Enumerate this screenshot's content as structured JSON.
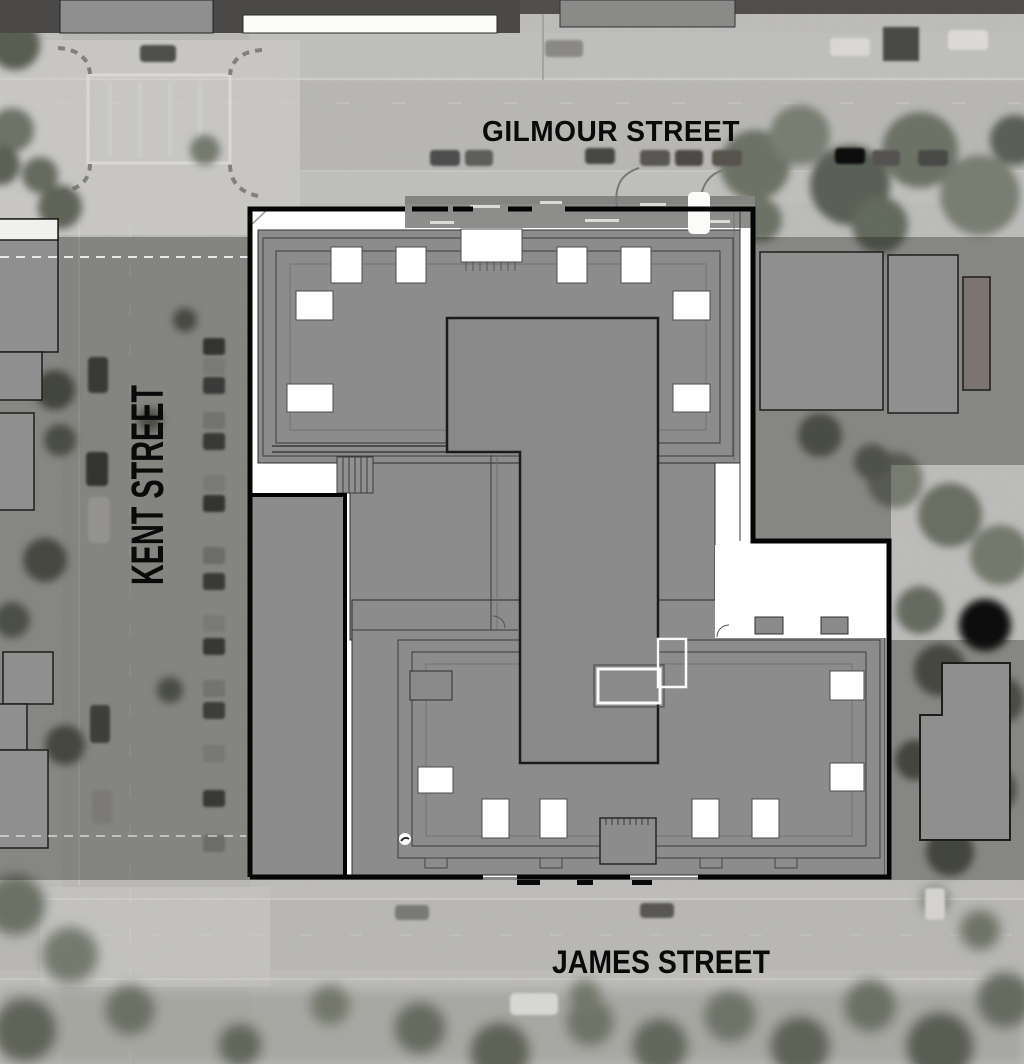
{
  "map": {
    "type": "aerial-site-plan",
    "streets": {
      "top": "GILMOUR STREET",
      "left": "KENT STREET",
      "bottom": "JAMES STREET"
    },
    "colors": {
      "photo_base": "#c8c7c5",
      "road": "#c3c2bf",
      "overlay": "#151512",
      "building_fill": "#8c8c8c",
      "context_building_fill": "#8f8f8f",
      "roof_element": "#ffffff",
      "boundary": "#050505",
      "label": "#0a0a0a"
    }
  }
}
